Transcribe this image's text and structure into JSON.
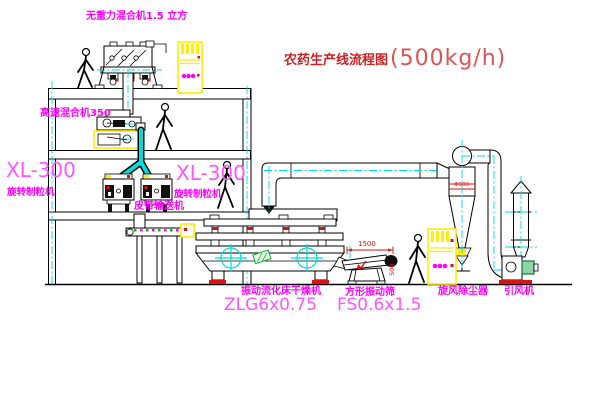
{
  "diagram": {
    "title": {
      "main": "农药生产线流程图",
      "capacity": "(500kg/h)"
    },
    "equipment_labels": {
      "gravity_mixer": "无重力混合机1.5 立方",
      "high_speed_mixer": "高速混合机350",
      "granulator_left_model": "XL-300",
      "granulator_left_name": "旋转制粒机",
      "granulator_right_model": "XL-300",
      "granulator_right_name": "旋转制粒机",
      "belt_conveyor": "皮带输送机",
      "fluid_bed_dryer": "振动流化床干燥机",
      "fluid_bed_dryer_model": "ZLG6x0.75",
      "vibrating_screen": "方形振动筛",
      "vibrating_screen_model": "FS0.6x1.5",
      "cyclone": "旋风除尘器",
      "induced_draft_fan": "引风机"
    },
    "dimensions": {
      "screen_length": "1500",
      "screen_height": "500",
      "cyclone_marking": "Φ600"
    },
    "colors": {
      "label": "#ff00ff",
      "model": "#ff55ff",
      "title": "#cc2222",
      "titlecap": "#d85555",
      "red": "#dd1111",
      "centerline": "#00dcdc",
      "highlight": "#ffee00",
      "green": "#11aa33"
    }
  }
}
